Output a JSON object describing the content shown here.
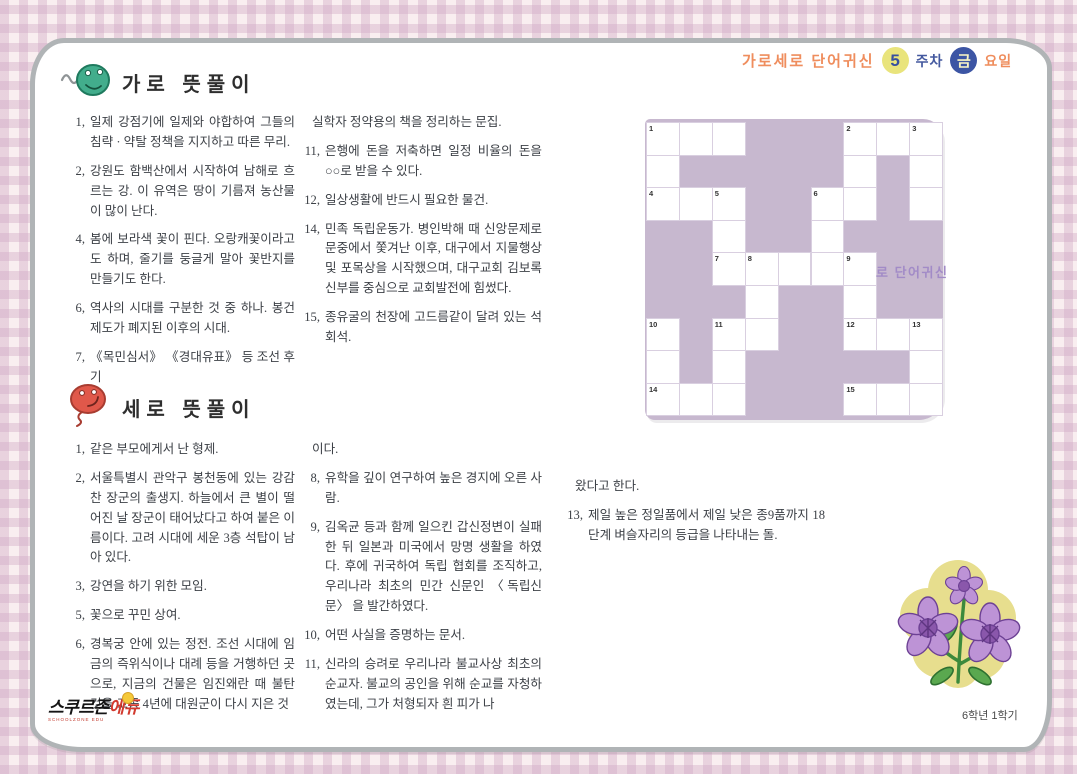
{
  "header": {
    "title": "가로세로 단어귀신",
    "week_number": "5",
    "week_label": "주차",
    "day_letter": "금",
    "day_label": "요일"
  },
  "across": {
    "title": "가로 뜻풀이",
    "col1": [
      {
        "num": "1,",
        "text": "일제 강점기에 일제와 야합하여 그들의 침략 · 약탈 정책을 지지하고 따른 무리."
      },
      {
        "num": "2,",
        "text": "강원도 함백산에서 시작하여 남해로 흐르는 강. 이 유역은 땅이 기름져 농산물이 많이 난다."
      },
      {
        "num": "4,",
        "text": "봄에 보라색 꽃이 핀다. 오랑캐꽃이라고도 하며, 줄기를 둥글게 말아 꽃반지를 만들기도 한다."
      },
      {
        "num": "6,",
        "text": "역사의 시대를 구분한 것 중 하나. 봉건 제도가 폐지된 이후의 시대."
      },
      {
        "num": "7,",
        "text": "《목민심서》 《경대유표》 등 조선 후기"
      }
    ],
    "col2": [
      {
        "num": "",
        "text": "실학자 정약용의 책을 정리하는 문집."
      },
      {
        "num": "11,",
        "text": "은행에 돈을 저축하면 일정 비율의 돈을 ○○로 받을 수 있다."
      },
      {
        "num": "12,",
        "text": "일상생활에 반드시 필요한 물건."
      },
      {
        "num": "14,",
        "text": "민족 독립운동가. 병인박해 때 신앙문제로 문중에서 쫓겨난 이후, 대구에서 지물행상 및 포목상을 시작했으며, 대구교회 김보록 신부를 중심으로 교회발전에 힘썼다."
      },
      {
        "num": "15,",
        "text": "종유굴의 천장에 고드름같이 달려 있는 석회석."
      }
    ]
  },
  "down": {
    "title": "세로 뜻풀이",
    "col1": [
      {
        "num": "1,",
        "text": "같은 부모에게서 난 형제."
      },
      {
        "num": "2,",
        "text": "서울특별시 관악구 봉천동에 있는 강감찬 장군의 출생지. 하늘에서 큰 별이 떨어진 날 장군이 태어났다고 하여 붙은 이름이다. 고려 시대에 세운 3층 석탑이 남아 있다."
      },
      {
        "num": "3,",
        "text": "강연을 하기 위한 모임."
      },
      {
        "num": "5,",
        "text": "꽃으로 꾸민 상여."
      },
      {
        "num": "6,",
        "text": "경복궁 안에 있는 정전. 조선 시대에 임금의 즉위식이나 대례 등을 거행하던 곳으로, 지금의 건물은 임진왜란 때 불탄 것을 고종 4년에 대원군이 다시 지은 것"
      }
    ],
    "col2": [
      {
        "num": "",
        "text": "이다."
      },
      {
        "num": "8,",
        "text": "유학을 깊이 연구하여 높은 경지에 오른 사람."
      },
      {
        "num": "9,",
        "text": "김옥균 등과 함께 일으킨 갑신정변이 실패한 뒤 일본과 미국에서 망명 생활을 하였다. 후에 귀국하여 독립 협회를 조직하고, 우리나라 최초의 민간 신문인 〈독립신문〉 을 발간하였다."
      },
      {
        "num": "10,",
        "text": "어떤 사실을 증명하는 문서."
      },
      {
        "num": "11,",
        "text": "신라의 승려로 우리나라 불교사상 최초의 순교자. 불교의 공인을 위해 순교를 자청하였는데, 그가 처형되자 흰 피가 나"
      }
    ],
    "col3": [
      {
        "num": "",
        "text": "왔다고 한다."
      },
      {
        "num": "13,",
        "text": "제일 높은 정일품에서 제일 낮은 종9품까지 18단계 벼슬자리의 등급을 나타내는 돌."
      }
    ]
  },
  "crossword": {
    "rows": 9,
    "cols": 9,
    "watermark": "로 단어귀신",
    "cells": [
      {
        "r": 1,
        "c": 1,
        "n": "1"
      },
      {
        "r": 1,
        "c": 2
      },
      {
        "r": 1,
        "c": 3
      },
      {
        "r": 1,
        "c": 7,
        "n": "2"
      },
      {
        "r": 1,
        "c": 8
      },
      {
        "r": 1,
        "c": 9,
        "n": "3"
      },
      {
        "r": 2,
        "c": 1
      },
      {
        "r": 2,
        "c": 7
      },
      {
        "r": 2,
        "c": 9
      },
      {
        "r": 3,
        "c": 1,
        "n": "4"
      },
      {
        "r": 3,
        "c": 2
      },
      {
        "r": 3,
        "c": 3,
        "n": "5"
      },
      {
        "r": 3,
        "c": 6,
        "n": "6"
      },
      {
        "r": 3,
        "c": 7
      },
      {
        "r": 3,
        "c": 9
      },
      {
        "r": 4,
        "c": 3
      },
      {
        "r": 4,
        "c": 6
      },
      {
        "r": 5,
        "c": 3,
        "n": "7"
      },
      {
        "r": 5,
        "c": 4,
        "n": "8"
      },
      {
        "r": 5,
        "c": 5
      },
      {
        "r": 5,
        "c": 6
      },
      {
        "r": 5,
        "c": 7,
        "n": "9"
      },
      {
        "r": 6,
        "c": 4
      },
      {
        "r": 6,
        "c": 7
      },
      {
        "r": 7,
        "c": 1,
        "n": "10"
      },
      {
        "r": 7,
        "c": 3,
        "n": "11"
      },
      {
        "r": 7,
        "c": 4
      },
      {
        "r": 7,
        "c": 7,
        "n": "12"
      },
      {
        "r": 7,
        "c": 8
      },
      {
        "r": 7,
        "c": 9,
        "n": "13"
      },
      {
        "r": 8,
        "c": 1
      },
      {
        "r": 8,
        "c": 3
      },
      {
        "r": 8,
        "c": 9
      },
      {
        "r": 9,
        "c": 1,
        "n": "14"
      },
      {
        "r": 9,
        "c": 2
      },
      {
        "r": 9,
        "c": 3
      },
      {
        "r": 9,
        "c": 7,
        "n": "15"
      },
      {
        "r": 9,
        "c": 8
      },
      {
        "r": 9,
        "c": 9
      }
    ]
  },
  "footer": {
    "logo_main": "스쿠르존",
    "logo_suffix": "에듀",
    "logo_sub": "SCHOOLZONE EDU",
    "grade": "6학년 1학기"
  },
  "colors": {
    "accent_orange": "#ef8d5d",
    "accent_blue": "#3c55a4",
    "accent_yellow": "#e9e47c",
    "grid_purple": "#c7b8cf",
    "watermark_purple": "#a28bc7",
    "logo_red": "#d23a2e"
  }
}
